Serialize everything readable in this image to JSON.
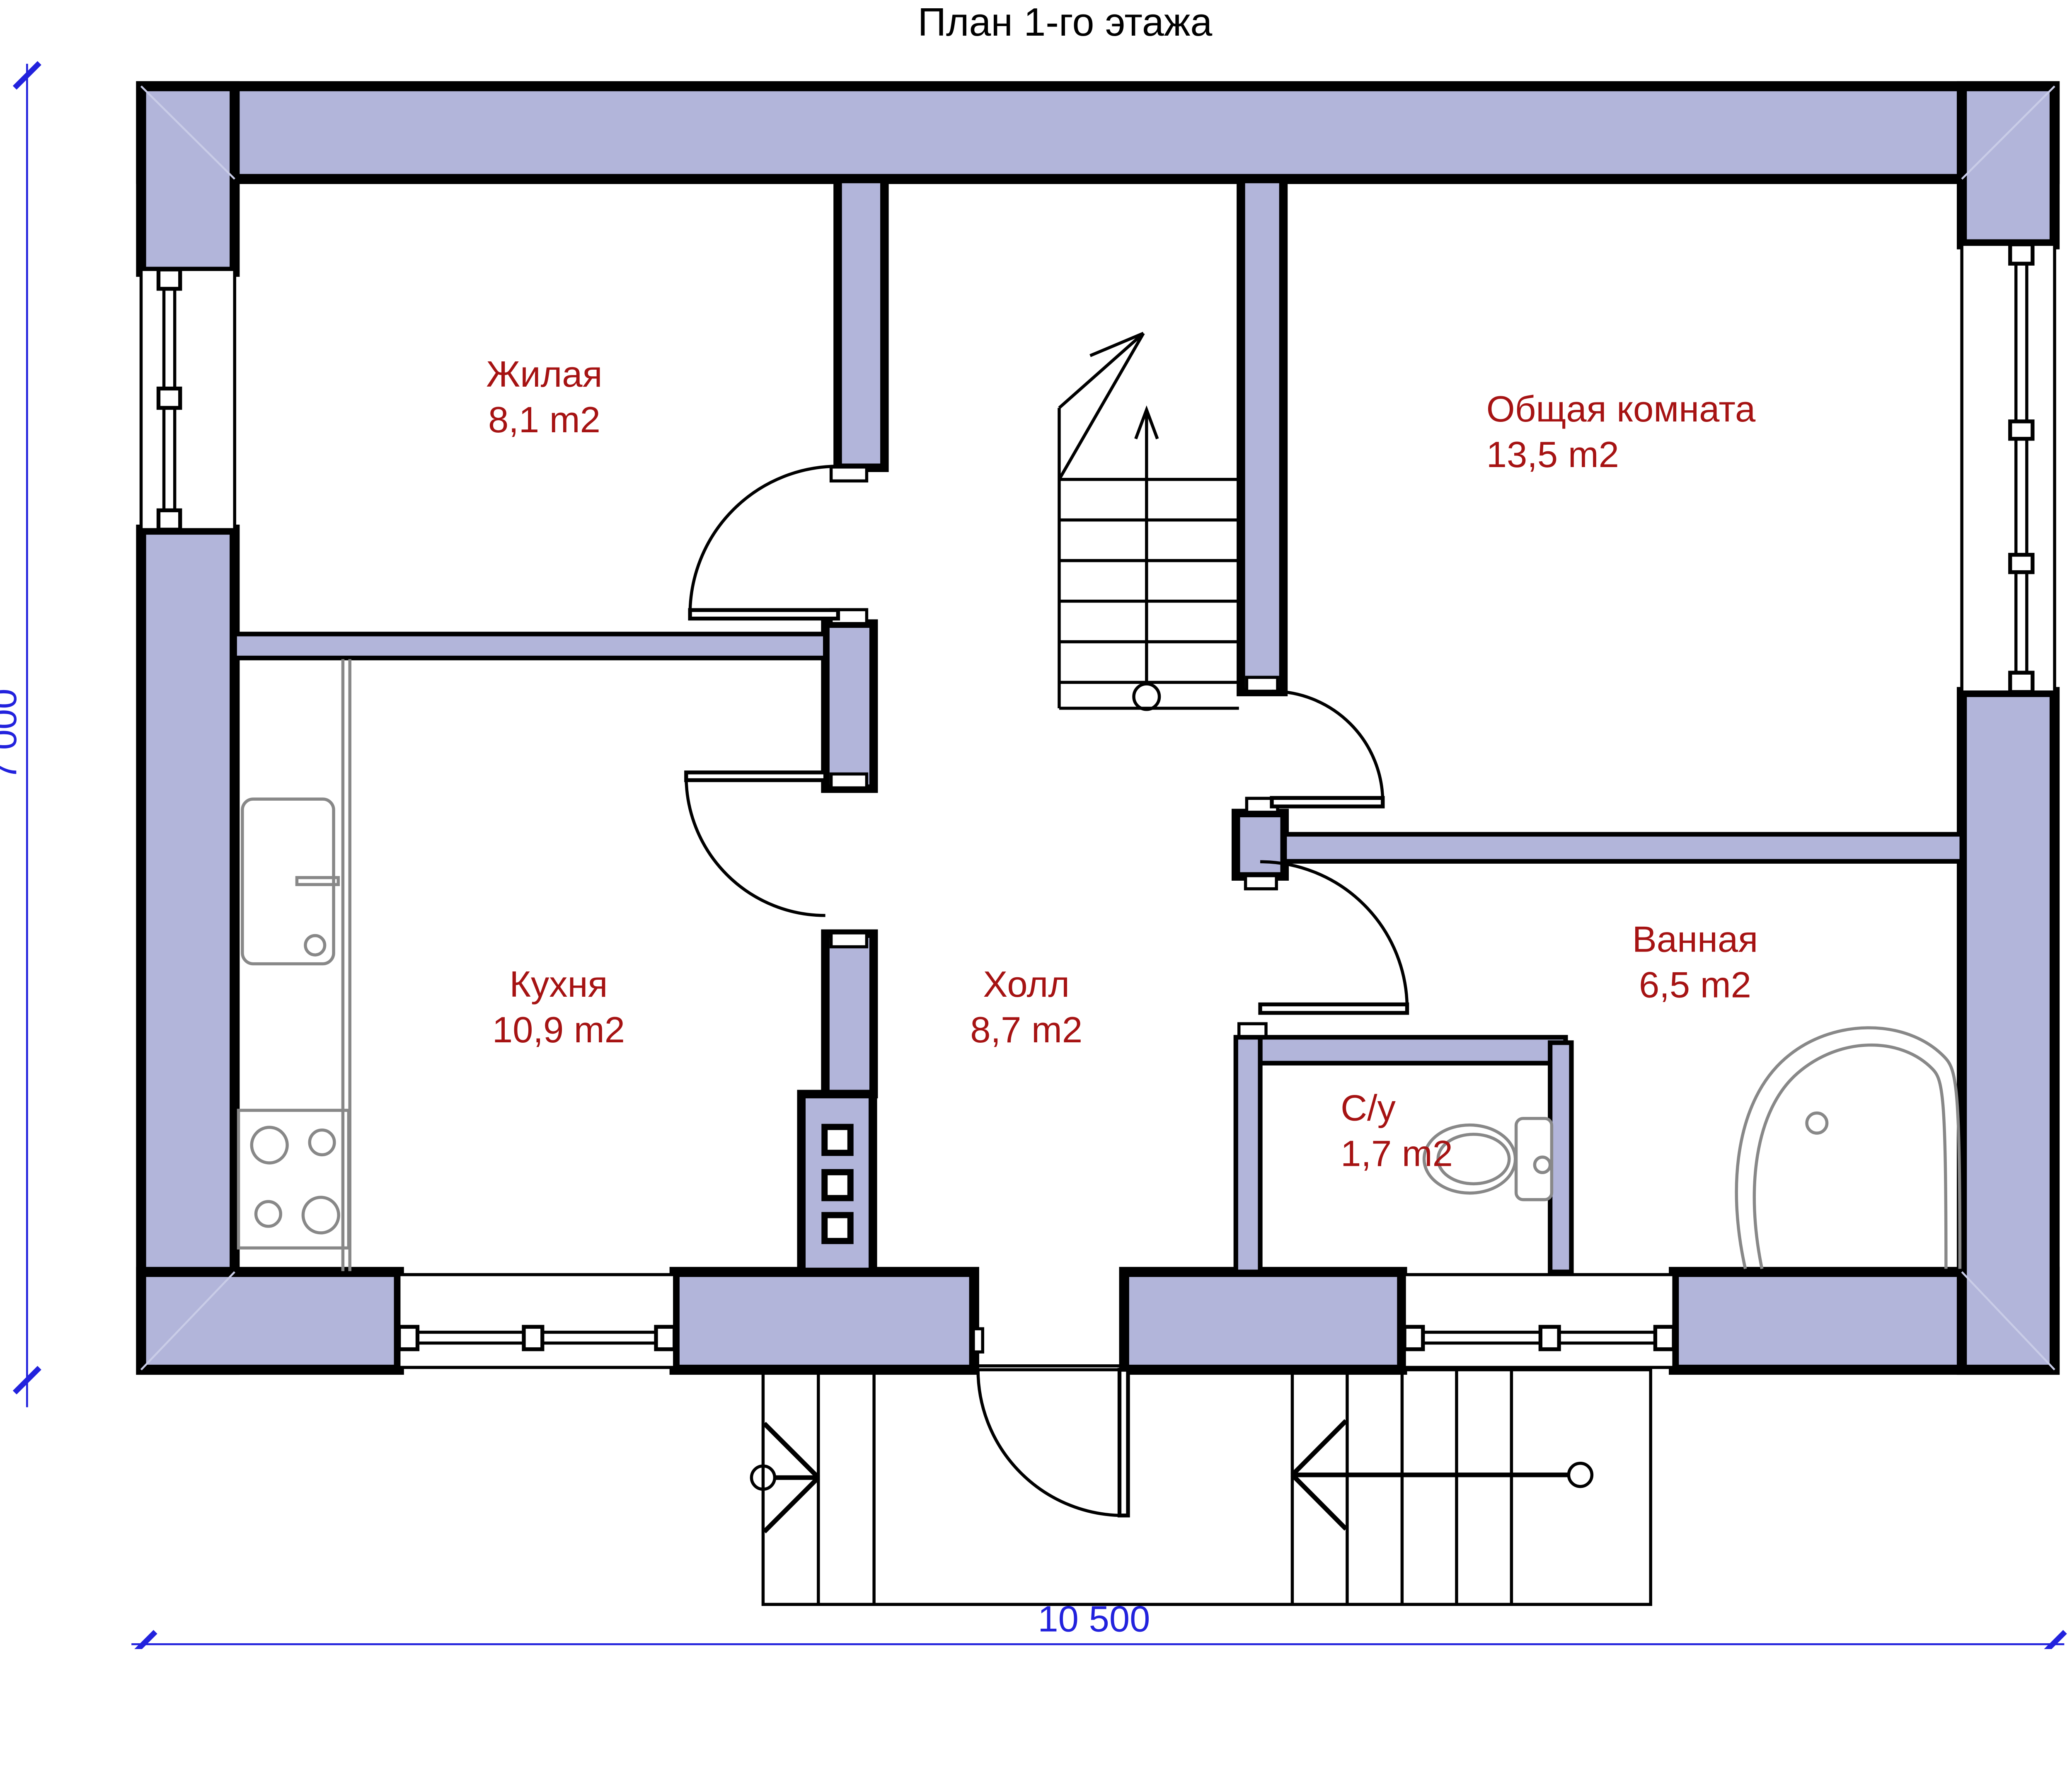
{
  "title": "План 1-го этажа",
  "colors": {
    "wall_fill": "#b2b5da",
    "outline": "#000000",
    "label": "#a61313",
    "dimension": "#2222dd",
    "fixture": "#888888",
    "seam": "#c9cce7"
  },
  "rooms": [
    {
      "id": "zhilaya",
      "name": "Жилая",
      "area": "8,1 m2"
    },
    {
      "id": "obshchaya",
      "name": "Общая комната",
      "area": "13,5 m2"
    },
    {
      "id": "kukhnya",
      "name": "Кухня",
      "area": "10,9 m2"
    },
    {
      "id": "kholl",
      "name": "Холл",
      "area": "8,7 m2"
    },
    {
      "id": "vannaya",
      "name": "Ванная",
      "area": "6,5 m2"
    },
    {
      "id": "su",
      "name": "С/у",
      "area": "1,7 m2"
    }
  ],
  "dimensions": {
    "width_label": "10 500",
    "height_label": "7 000"
  }
}
